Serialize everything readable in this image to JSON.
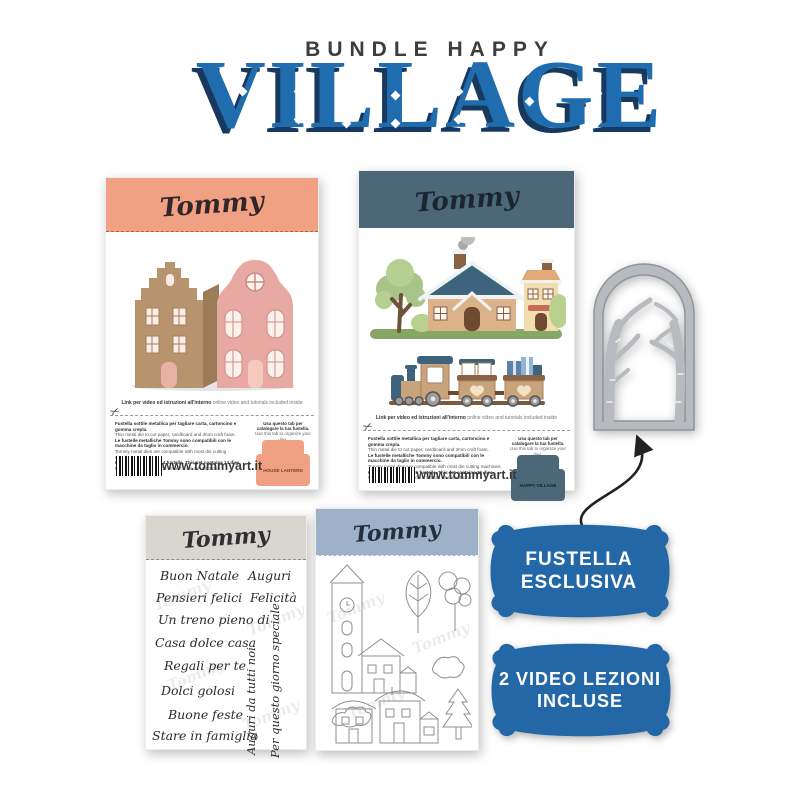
{
  "header": {
    "kicker": "BUNDLE HAPPY",
    "title": "VILLAGE",
    "title_color": "#1f6cae",
    "title_shadow_color": "#18395f",
    "kicker_color": "#3d3d3d"
  },
  "brand": {
    "signature": "Tommy",
    "website": "www.tommyart.it"
  },
  "icons": {
    "scissors_icon": "✂"
  },
  "package_house_lantern": {
    "header_color": "#f0a183",
    "link_line_it": "Link per video ed istruzioni all'interno",
    "link_line_en": "online video and tutorials included inside",
    "fineprint": [
      "Fustella sottile metallica per tagliare carta, cartoncino e gomma crepla.",
      "Thin metal die to cut paper, cardboard and 3mm craft foam.",
      "Le fustelle metalliche Tommy sono compatibili con le macchine da taglio in commercio.",
      "Tommy metal dies are compatible with most die cutting machines.",
      "Questo set contiene 14 fustelle. This set contains 14 dies.",
      "Misura della lanterna: 7,2 cm x 7,2 cm x H 14,3 cm"
    ],
    "tab_note_it": "Usa questo tab per catalogare la tua fustella.",
    "tab_note_en": "Use this tab to organize your dies.",
    "tab_label": "HOUSE LANTERN"
  },
  "package_happy_village": {
    "header_color": "#4c6878",
    "link_line_it": "Link per video ed istruzioni all'interno",
    "link_line_en": "online video and tutorials included inside",
    "fineprint": [
      "Fustella sottile metallica per tagliare carta, cartoncino e gomma crepla.",
      "Thin metal die to cut paper, cardboard and 3mm craft foam.",
      "Le fustelle metalliche Tommy sono compatibili con le macchine da taglio in commercio.",
      "Tommy metal dies are compatible with most die cutting machines.",
      "Questo set contiene 26 fustelle. This set contains 26 dies.",
      "Misura dei disegni: 7,5 cm x 5,5 cm - 4 cm x 4 cm"
    ],
    "tab_note_it": "Usa questo tab per catalogare la tua fustella.",
    "tab_note_en": "Use this tab to organize your dies.",
    "tab_label": "HAPPY VILLAGE"
  },
  "stamp_text_set": {
    "header_color": "#d9d5cf",
    "phrases": [
      "Buon Natale",
      "Auguri",
      "Pensieri felici",
      "Felicità",
      "Un treno pieno di",
      "Casa dolce casa",
      "Regali per te",
      "Dolci golosi",
      "Buone feste",
      "Stare in famiglia"
    ],
    "vertical_phrases": [
      "Auguri da tutti noi",
      "Per questo giorno speciale"
    ]
  },
  "stamp_art_set": {
    "header_color": "#9db2c8",
    "motifs": [
      "clock-tower",
      "leaf-tree",
      "balloon-tree",
      "bushes",
      "snowy-houses",
      "pine-tree"
    ]
  },
  "badges": [
    {
      "line1": "FUSTELLA",
      "line2": "ESCLUSIVA",
      "color": "#2367a6"
    },
    {
      "line1": "2 VIDEO LEZIONI",
      "line2": "INCLUSE",
      "color": "#2367a6"
    }
  ],
  "die_cutout": {
    "description": "arched birch-branches die",
    "color": "#b7bbbf"
  }
}
